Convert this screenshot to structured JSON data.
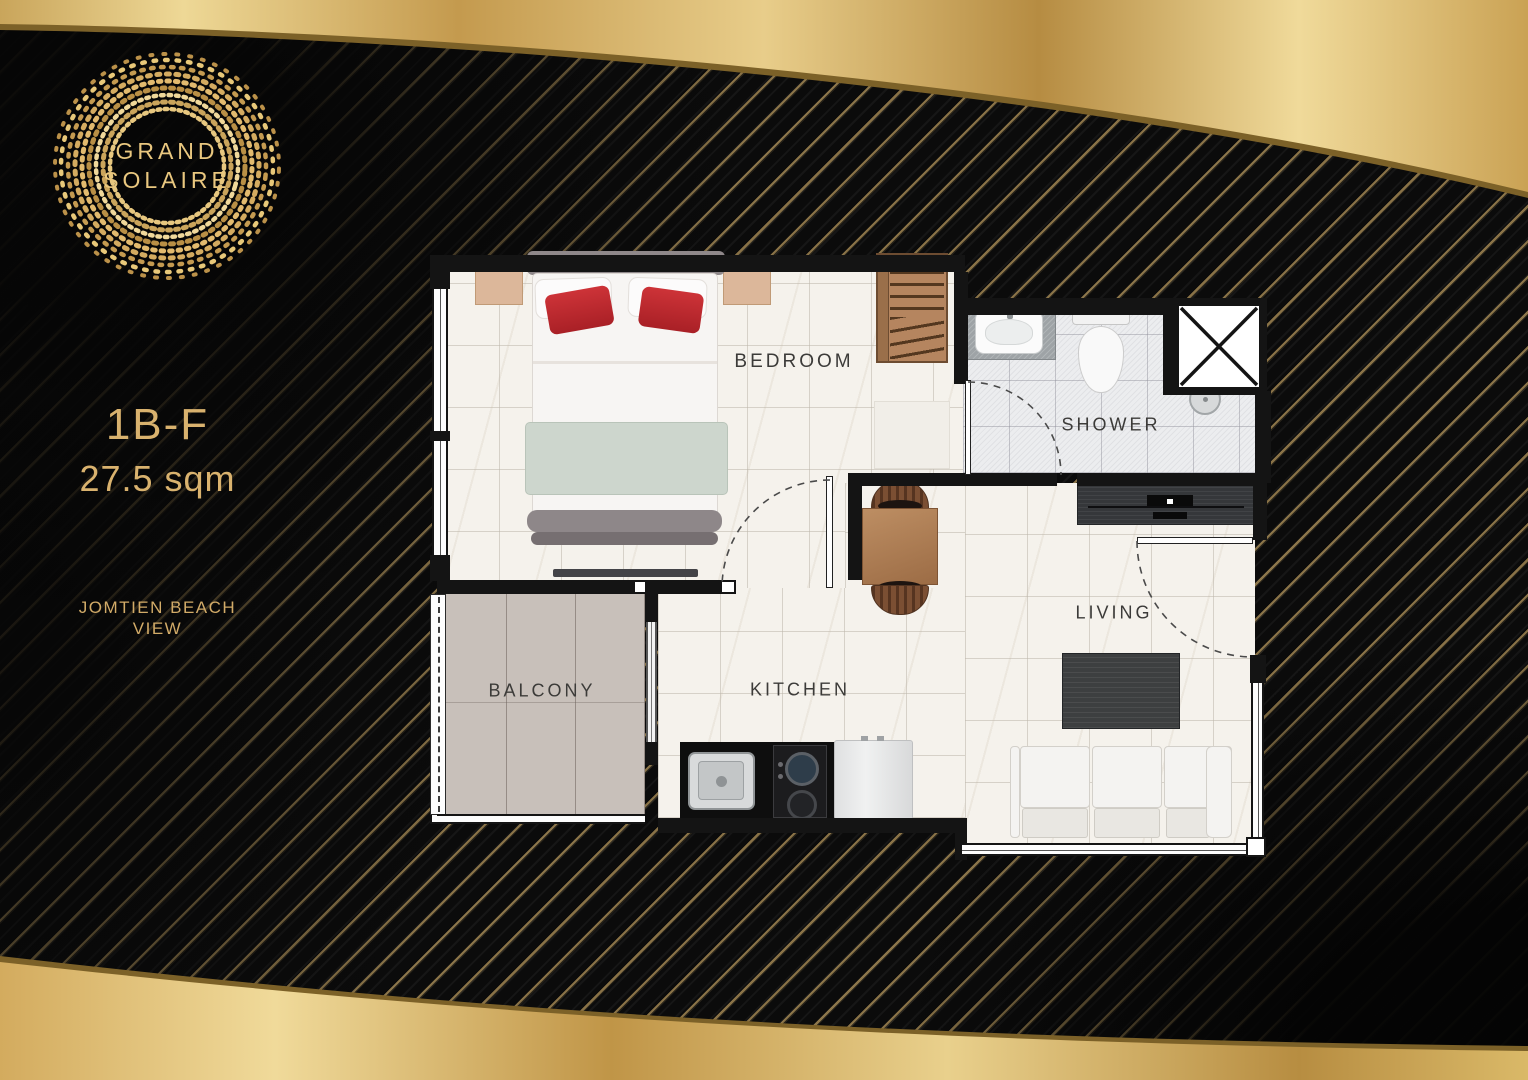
{
  "brand": {
    "name_line1": "GRAND",
    "name_line2": "SOLAIRE"
  },
  "unit": {
    "code": "1B-F",
    "area": "27.5 sqm",
    "view_line1": "JOMTIEN BEACH",
    "view_line2": "VIEW"
  },
  "rooms": {
    "bedroom": "BEDROOM",
    "shower": "SHOWER",
    "living": "LIVING",
    "kitchen": "KITCHEN",
    "balcony": "BALCONY"
  },
  "furniture": [
    "double-bed",
    "nightstand-left",
    "nightstand-right",
    "wardrobe",
    "bedroom-tv",
    "vanity-sink",
    "toilet",
    "shower-set",
    "dining-table",
    "dining-chairs",
    "tv-console",
    "coffee-table",
    "sofa",
    "kitchen-counter",
    "kitchen-sink",
    "gas-hob",
    "fridge"
  ],
  "colors": {
    "background": "#0b0b0b",
    "gold_band": "#d8b571",
    "gold_text": "#d9b26e",
    "logo_gold": "#e9c77f",
    "wall": "#141414",
    "marble_floor": "#f5f2ec",
    "bath_floor": "#ecedef",
    "balcony_floor": "#c8c0ba",
    "label_text": "#3c3b39",
    "red_pillow": "#bf2a30",
    "wood": "#b2805a"
  }
}
